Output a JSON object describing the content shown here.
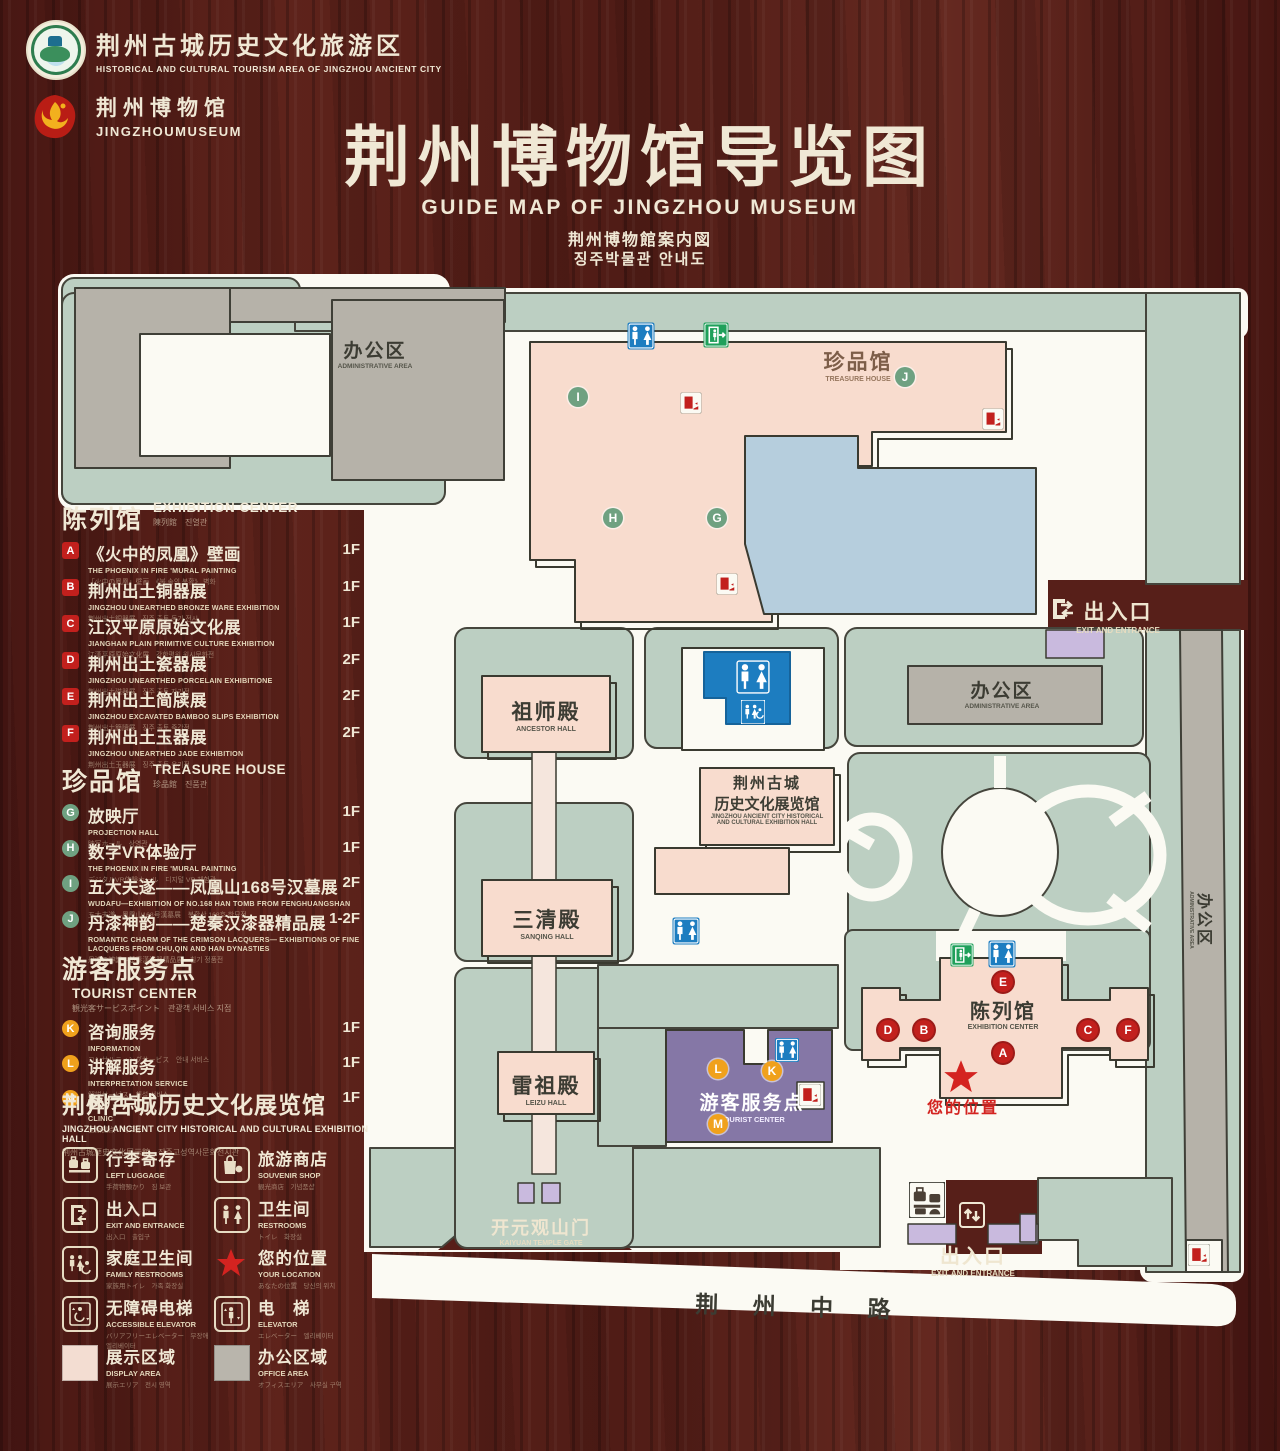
{
  "header": {
    "logo1": {
      "title": "荆州古城历史文化旅游区",
      "subtitle": "HISTORICAL AND CULTURAL TOURISM AREA OF JINGZHOU ANCIENT CITY"
    },
    "logo2": {
      "title": "荆州博物馆",
      "subtitle": "JINGZHOUMUSEUM"
    },
    "title": "荆州博物馆导览图",
    "subtitle_en": "GUIDE MAP OF JINGZHOU MUSEUM",
    "subtitle_ja": "荆州博物館案内図",
    "subtitle_ko": "징주박물관 안내도"
  },
  "sidebar": {
    "sections": [
      {
        "id": "exhibition-center",
        "top": 500,
        "title": "陈列馆",
        "en": "EXHIBITION CENTER",
        "sub": "陳列館　진열관",
        "chip": "red-square",
        "pitch": 36.5,
        "items": [
          {
            "key": "A",
            "title": "《火中的凤凰》壁画",
            "en": "THE PHOENIX IN FIRE 'MURAL PAINTING",
            "sub": "「火中の鳳凰」壁画　《불 속의 봉황》 벽화",
            "floor": "1F"
          },
          {
            "key": "B",
            "title": "荆州出土铜器展",
            "en": "JINGZHOU UNEARTHED BRONZE WARE EXHIBITION",
            "sub": "荆州出土銅器展　징주 출토 동기 전시",
            "floor": "1F"
          },
          {
            "key": "C",
            "title": "江汉平原原始文化展",
            "en": "JIANGHAN PLAIN PRIMITIVE CULTURE EXHIBITION",
            "sub": "江漢平原原始文化展　강한평원 원시문화전",
            "floor": "1F"
          },
          {
            "key": "D",
            "title": "荆州出土瓷器展",
            "en": "JINGZHOU UNEARTHED PORCELAIN EXHIBITIONE",
            "sub": "荆州出土磁器展　징주 출토 자기전",
            "floor": "2F"
          },
          {
            "key": "E",
            "title": "荆州出土简牍展",
            "en": "JINGZHOU EXCAVATED BAMBOO SLIPS EXHIBITION",
            "sub": "荆州出土簡牘展　징주 출토 죽간전",
            "floor": "2F"
          },
          {
            "key": "F",
            "title": "荆州出土玉器展",
            "en": "JINGZHOU UNEARTHED JADE EXHIBITION",
            "sub": "荆州出土玉器展　징주 출토 옥기전",
            "floor": "2F"
          }
        ]
      },
      {
        "id": "treasure-house",
        "top": 762,
        "title": "珍品馆",
        "en": "TREASURE HOUSE",
        "sub": "珍品館　진품관",
        "chip": "green-circle",
        "pitch": 35.5,
        "items": [
          {
            "key": "G",
            "title": "放映厅",
            "en": "PROJECTION HALL",
            "sub": "映写ホール　상영관",
            "floor": "1F"
          },
          {
            "key": "H",
            "title": "数字VR体验厅",
            "en": "THE PHOENIX IN FIRE 'MURAL PAINTING",
            "sub": "デジタルVR体験ホール　디지털 VR 체험관",
            "floor": "1F"
          },
          {
            "key": "I",
            "title": "五大夫遂——凤凰山168号汉墓展",
            "en": "WUDAFU—EXHIBITION OF NO.168 HAN TOMB FROM FENGHUANGSHAN",
            "sub": "五大夫遂—鳳凰山168号漢墓展　봉황산 168호 한묘전",
            "floor": "2F"
          },
          {
            "key": "J",
            "title": "丹漆神韵——楚秦汉漆器精品展",
            "en": "ROMANTIC CHARM OF THE CRIMSON LACQUERS— EXHIBITIONS OF FINE LACQUERS FROM CHU,QIN AND HAN DYNASTIES",
            "sub": "丹漆の神韻—楚秦漢漆器精品展　칠기 정품전",
            "floor": "1-2F",
            "h": 52
          }
        ]
      },
      {
        "id": "tourist-center",
        "top": 950,
        "title": "游客服务点",
        "en": "TOURIST CENTER",
        "sub": "観光客サービスポイント　관광객 서비스 지점",
        "chip": "orange-circle",
        "pitch": 35,
        "items": [
          {
            "key": "K",
            "title": "咨询服务",
            "en": "INFORMATION",
            "sub": "コンサルティングサービス　안내 서비스",
            "floor": "1F"
          },
          {
            "key": "L",
            "title": "讲解服务",
            "en": "INTERPRETATION SERVICE",
            "sub": "解説サービス　해설 서비스",
            "floor": "1F"
          },
          {
            "key": "M",
            "title": "医疗点",
            "en": "CLINIC",
            "sub": "医療拠点　의료점",
            "floor": "1F"
          }
        ]
      }
    ],
    "hall_note": {
      "title": "荆州古城历史文化展览馆",
      "en": "JINGZHOU ANCIENT CITY HISTORICAL AND CULTURAL EXHIBITION HALL",
      "sub": "荆州古城歴史文化展示館　징주고성역사문화전시관"
    },
    "legend": [
      {
        "icon": "left-luggage",
        "title": "行李寄存",
        "en": "LEFT LUGGAGE",
        "sub": "手荷物預かり　짐 보관"
      },
      {
        "icon": "souvenir-shop",
        "title": "旅游商店",
        "en": "SOUVENIR SHOP",
        "sub": "観光商店　기념품샵"
      },
      {
        "icon": "exit-entrance",
        "title": "出入口",
        "en": "EXIT AND ENTRANCE",
        "sub": "出入口　출입구"
      },
      {
        "icon": "restrooms",
        "title": "卫生间",
        "en": "RESTROOMS",
        "sub": "トイレ　화장실"
      },
      {
        "icon": "family-restrooms",
        "title": "家庭卫生间",
        "en": "FAMILY RESTROOMS",
        "sub": "家族用トイレ　가족 화장실"
      },
      {
        "icon": "your-location",
        "title": "您的位置",
        "en": "YOUR LOCATION",
        "sub": "あなたの位置　당신의 위치"
      },
      {
        "icon": "accessible-elevator",
        "title": "无障碍电梯",
        "en": "ACCESSIBLE ELEVATOR",
        "sub": "バリアフリーエレベーター　무장애 엘리베이터"
      },
      {
        "icon": "elevator",
        "title": "电　梯",
        "en": "ELEVATOR",
        "sub": "エレベーター　엘리베이터"
      },
      {
        "icon": "display-area",
        "title": "展示区域",
        "en": "DISPLAY AREA",
        "sub": "展示エリア　전시 영역"
      },
      {
        "icon": "office-area",
        "title": "办公区域",
        "en": "OFFICE AREA",
        "sub": "オフィスエリア　사무실 구역"
      }
    ]
  },
  "map": {
    "labels": [
      {
        "name": "admin-area-topleft",
        "text": "办公区",
        "en": "ADMINISTRATIVE AREA",
        "x": 375,
        "y": 336,
        "theme": "dark",
        "size": 19,
        "esize": 6.5
      },
      {
        "name": "treasure-house",
        "text": "珍品馆",
        "en": "TREASURE HOUSE",
        "x": 858,
        "y": 346,
        "theme": "brown",
        "size": 21,
        "esize": 7
      },
      {
        "name": "exit-top-right",
        "text": "出入口",
        "en": "EXIT AND ENTRANCE",
        "x": 1118,
        "y": 596,
        "theme": "cream",
        "size": 21,
        "esize": 8
      },
      {
        "name": "admin-area-right",
        "text": "办公区",
        "en": "ADMINISTRATIVE AREA",
        "x": 1002,
        "y": 676,
        "theme": "dark",
        "size": 19,
        "esize": 6.5
      },
      {
        "name": "ancestor-hall",
        "text": "祖师殿",
        "en": "ANCESTOR HALL",
        "x": 546,
        "y": 696,
        "theme": "dark",
        "size": 21,
        "esize": 7
      },
      {
        "name": "ancient-city-hall",
        "text": "荆州古城",
        "text2": "历史文化展览馆",
        "en": "JINGZHOU ANCIENT CITY HISTORICAL",
        "en2": "AND CULTURAL EXHIBITION HALL",
        "x": 767,
        "y": 772,
        "theme": "dark",
        "size": 15,
        "esize": 6
      },
      {
        "name": "sanqing-hall",
        "text": "三清殿",
        "en": "SANQING HALL",
        "x": 547,
        "y": 904,
        "theme": "dark",
        "size": 21,
        "esize": 7
      },
      {
        "name": "leizu-hall",
        "text": "雷祖殿",
        "en": "LEIZU HALL",
        "x": 546,
        "y": 1070,
        "theme": "dark",
        "size": 21,
        "esize": 7
      },
      {
        "name": "tourist-center",
        "text": "游客服务点",
        "en": "TOURIST CENTER",
        "x": 752,
        "y": 1088,
        "theme": "white",
        "size": 19,
        "esize": 7.5
      },
      {
        "name": "exhibition-center",
        "text": "陈列馆",
        "en": "EXHIBITION CENTER",
        "x": 1003,
        "y": 995,
        "theme": "dark",
        "size": 20,
        "esize": 7
      },
      {
        "name": "your-location",
        "text": "您的位置",
        "en": "",
        "x": 963,
        "y": 1094,
        "theme": "red",
        "size": 16,
        "esize": 6
      },
      {
        "name": "kaiyuan-temple-gate",
        "text": "开元观山门",
        "en": "KAIYUAN TEMPLE GATE",
        "x": 541,
        "y": 1214,
        "theme": "cream",
        "size": 18,
        "esize": 7
      },
      {
        "name": "exit-bottom",
        "text": "出入口",
        "en": "EXIT AND ENTRANCE",
        "x": 973,
        "y": 1240,
        "theme": "cream",
        "size": 20,
        "esize": 8
      },
      {
        "name": "jingzhou-middle-road",
        "text": "荆 州 中 路",
        "en": "",
        "x": 800,
        "y": 1288,
        "theme": "dark",
        "size": 23,
        "esize": 6,
        "rotate": 1.6
      },
      {
        "name": "admin-area-strip",
        "text": "办公区",
        "en": "ADMINISTRATIVE AREA",
        "x": 1203,
        "y": 905,
        "theme": "dark",
        "size": 16,
        "esize": 5,
        "rotate": 90
      }
    ],
    "markers": [
      {
        "label": "I",
        "type": "green",
        "x": 578,
        "y": 397
      },
      {
        "label": "J",
        "type": "green",
        "x": 905,
        "y": 377
      },
      {
        "label": "H",
        "type": "green",
        "x": 613,
        "y": 518
      },
      {
        "label": "G",
        "type": "green",
        "x": 717,
        "y": 518
      },
      {
        "label": "E",
        "type": "red",
        "x": 1003,
        "y": 982
      },
      {
        "label": "D",
        "type": "red",
        "x": 888,
        "y": 1030
      },
      {
        "label": "B",
        "type": "red",
        "x": 924,
        "y": 1030
      },
      {
        "label": "C",
        "type": "red",
        "x": 1088,
        "y": 1030
      },
      {
        "label": "F",
        "type": "red",
        "x": 1128,
        "y": 1030
      },
      {
        "label": "A",
        "type": "red",
        "x": 1003,
        "y": 1053
      },
      {
        "label": "L",
        "type": "orange",
        "x": 718,
        "y": 1069
      },
      {
        "label": "K",
        "type": "orange",
        "x": 772,
        "y": 1071
      },
      {
        "label": "M",
        "type": "orange",
        "x": 718,
        "y": 1124
      }
    ],
    "icons": [
      {
        "type": "restroom",
        "x": 641,
        "y": 336,
        "s": 27
      },
      {
        "type": "exit",
        "x": 716,
        "y": 335,
        "s": 25
      },
      {
        "type": "escalator",
        "x": 691,
        "y": 403,
        "s": 21
      },
      {
        "type": "escalator",
        "x": 993,
        "y": 419,
        "s": 21
      },
      {
        "type": "escalator",
        "x": 727,
        "y": 584,
        "s": 21
      },
      {
        "type": "exit-arrows",
        "x": 1063,
        "y": 609,
        "s": 28
      },
      {
        "type": "restroom",
        "x": 753,
        "y": 677,
        "s": 36
      },
      {
        "type": "family-white",
        "x": 753,
        "y": 712,
        "s": 24
      },
      {
        "type": "restroom",
        "x": 686,
        "y": 931,
        "s": 27
      },
      {
        "type": "exit",
        "x": 962,
        "y": 955,
        "s": 23
      },
      {
        "type": "restroom",
        "x": 1002,
        "y": 954,
        "s": 27
      },
      {
        "type": "restroom",
        "x": 787,
        "y": 1050,
        "s": 24
      },
      {
        "type": "escalator",
        "x": 810,
        "y": 1095,
        "s": 22
      },
      {
        "type": "star",
        "x": 961,
        "y": 1077,
        "s": 38
      },
      {
        "type": "luggage",
        "x": 927,
        "y": 1200,
        "s": 36
      },
      {
        "type": "updown",
        "x": 972,
        "y": 1215,
        "s": 28
      },
      {
        "type": "escalator",
        "x": 1199,
        "y": 1255,
        "s": 22
      }
    ]
  },
  "colors": {
    "wood": "#541e18",
    "cream": "#f0e8d5",
    "lawn": "#bccfc2",
    "building_gray": "#b6b2a9",
    "building_pink": "#f8dcce",
    "pond_blue": "#b6cedd",
    "purple": "#8577a6",
    "gate_purple": "#c9bade",
    "icon_blue": "#1d7dc0",
    "icon_green": "#1fa05a",
    "icon_red": "#c2201d",
    "marker_orange": "#f0a11c"
  }
}
